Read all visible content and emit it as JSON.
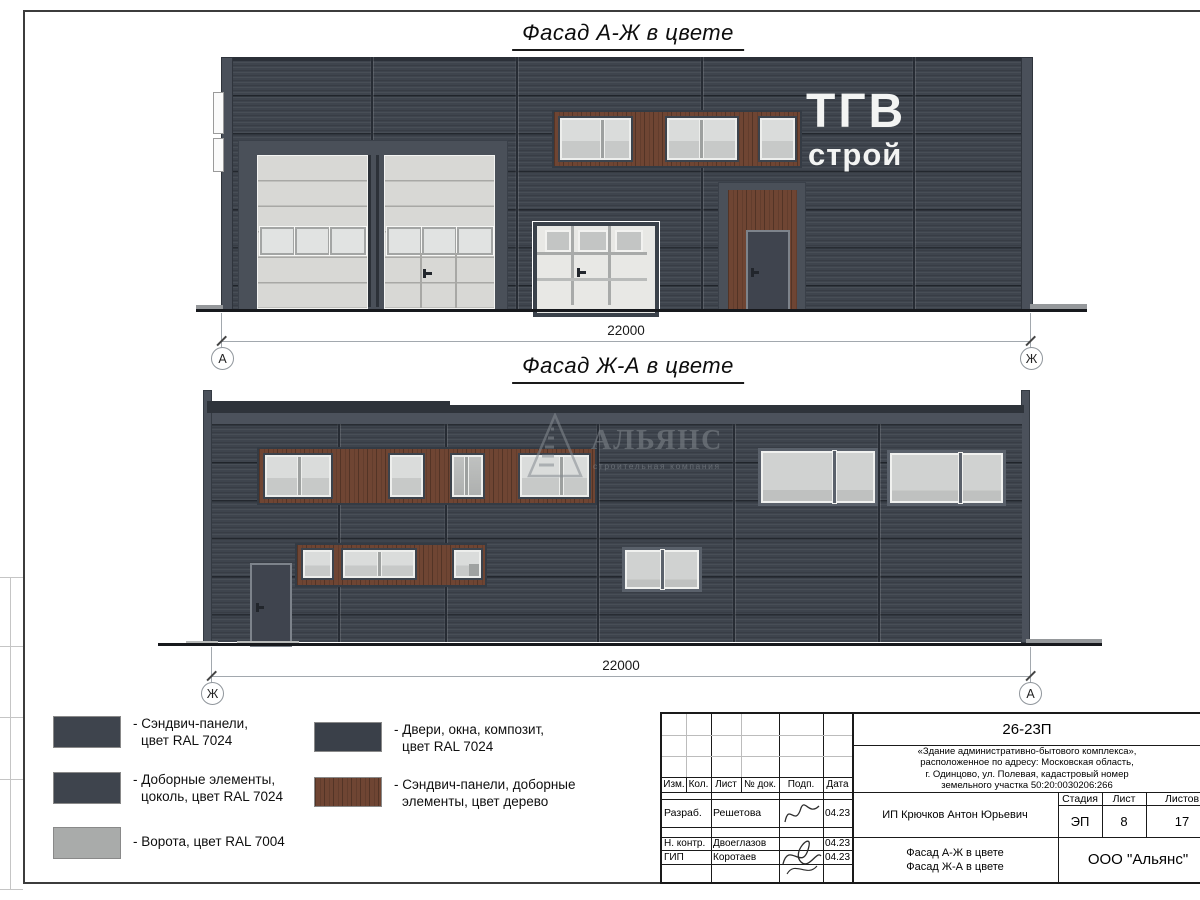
{
  "sheet": {
    "titles": {
      "facade1": "Фасад А-Ж в цвете",
      "facade2": "Фасад Ж-А в цвете"
    }
  },
  "facade1": {
    "dimension": "22000",
    "axis_left": "А",
    "axis_right": "Ж",
    "logo": {
      "line1": "ТГВ",
      "line2": "строй"
    }
  },
  "facade2": {
    "dimension": "22000",
    "axis_left": "Ж",
    "axis_right": "А",
    "watermark": {
      "name": "АЛЬЯНС",
      "tagline": "строительная компания"
    }
  },
  "legend": {
    "items": [
      {
        "color": "#3e444d",
        "line1": "- Сэндвич-панели,",
        "line2": "цвет RAL 7024"
      },
      {
        "color": "#3e444d",
        "line1": "- Доборные элементы,",
        "line2": "цоколь, цвет RAL 7024"
      },
      {
        "color": "#a9abaa",
        "line1": "- Ворота, цвет RAL 7004",
        "line2": ""
      },
      {
        "color": "#3a4049",
        "line1": "- Двери, окна, композит,",
        "line2": "цвет RAL 7024"
      },
      {
        "color": "#6f4533",
        "line1": "- Сэндвич-панели, доборные",
        "line2": "элементы, цвет дерево"
      }
    ]
  },
  "stamp": {
    "doc_number": "26-23П",
    "description": [
      "«Здание административно-бытового комплекса»,",
      "расположенное по адресу: Московская область,",
      "г. Одинцово, ул. Полевая, кадастровый номер",
      "земельного участка 50:20:0030206:266"
    ],
    "header": {
      "izm": "Изм.",
      "kol": "Кол.",
      "list": "Лист",
      "doc": "№ док.",
      "podp": "Подп.",
      "data": "Дата"
    },
    "rows": [
      {
        "role": "Разраб.",
        "name": "Решетова",
        "date": "04.23"
      },
      {
        "role": "Н. контр.",
        "name": "Двоеглазов",
        "date": "04.23"
      },
      {
        "role": "ГИП",
        "name": "Коротаев",
        "date": "04.23"
      }
    ],
    "client": "ИП Крючков Антон Юрьевич",
    "stage_label": "Стадия",
    "sheet_label": "Лист",
    "sheets_label": "Листов",
    "stage": "ЭП",
    "sheet_num": "8",
    "sheets_total": "17",
    "subject_line1": "Фасад А-Ж в цвете",
    "subject_line2": "Фасад Ж-А в цвете",
    "company": "ООО \"Альянс\""
  },
  "colors": {
    "wall_ral7024": "#3e444d",
    "gate_ral7004": "#a9abaa",
    "wood": "#6f4533",
    "glass": "#d2d4d3",
    "frame_dark": "#3a414a"
  }
}
